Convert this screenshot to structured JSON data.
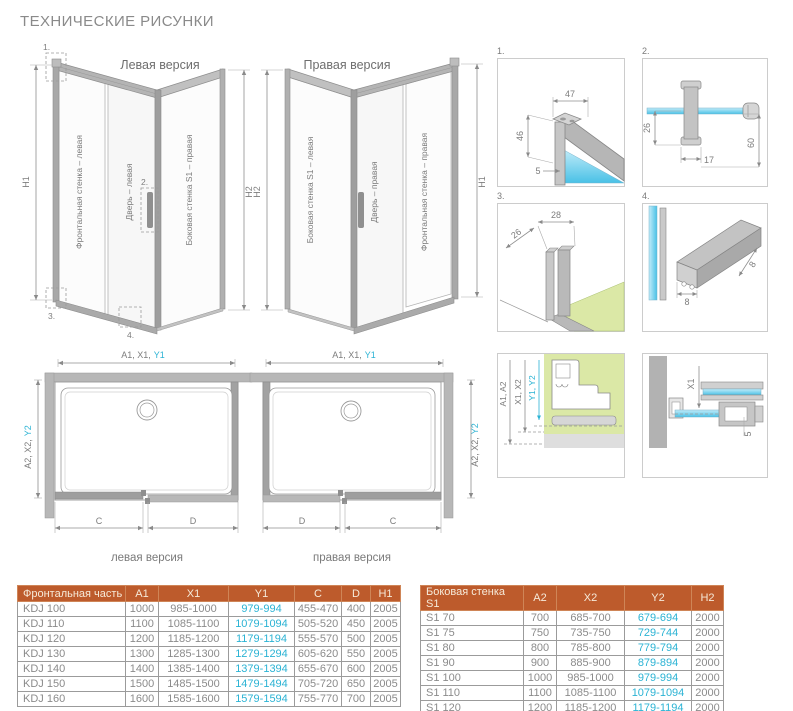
{
  "title": "ТЕХНИЧЕСКИЕ РИСУНКИ",
  "colors": {
    "accent_orange": "#bd5b2c",
    "cyan": "#2bb3d4",
    "wall_green": "#dbe8a6",
    "glass_blue": "#49c1e6",
    "line_gray": "#8f8f8f"
  },
  "iso_left": {
    "caption": "Левая версия",
    "panel_front": "Фронтальная стенка – левая",
    "panel_door": "Дверь – левая",
    "panel_side": "Боковая стенка S1 – правая",
    "dim_left": "H1",
    "dim_right": "H2"
  },
  "iso_right": {
    "caption": "Правая версия",
    "panel_side": "Боковая стенка S1 – левая",
    "panel_door": "Дверь – правая",
    "panel_front": "Фронтальная стенка – правая",
    "dim_left": "H2",
    "dim_right": "H1"
  },
  "details": {
    "d1": {
      "label": "1.",
      "a": "47",
      "b": "46",
      "c": "5"
    },
    "d2": {
      "label": "2.",
      "a": "26",
      "b": "17",
      "c": "60"
    },
    "d3": {
      "label": "3.",
      "a": "28",
      "b": "26"
    },
    "d4": {
      "label": "4.",
      "a": "8",
      "b": "8"
    },
    "d5": {
      "a": "A1, A2",
      "b": "X1, X2",
      "c": "Y1, Y2"
    },
    "d6": {
      "a": "X1",
      "b": "5"
    }
  },
  "plan_left": {
    "caption": "левая версия",
    "top_dim": "A1, X1,",
    "top_dim_cyan": "Y1",
    "side_dim": "A2, X2,",
    "side_dim_cyan": "Y2",
    "dim_c": "C",
    "dim_d": "D"
  },
  "plan_right": {
    "caption": "правая версия",
    "top_dim": "A1, X1,",
    "top_dim_cyan": "Y1",
    "side_dim": "A2, X2,",
    "side_dim_cyan": "Y2",
    "dim_c": "C",
    "dim_d": "D"
  },
  "tables": {
    "front": {
      "headers": [
        "Фронтальная часть",
        "A1",
        "X1",
        "Y1",
        "C",
        "D",
        "H1"
      ],
      "cyan_col": 3,
      "rows": [
        [
          "KDJ 100",
          "1000",
          "985-1000",
          "979-994",
          "455-470",
          "400",
          "2005"
        ],
        [
          "KDJ 110",
          "1100",
          "1085-1100",
          "1079-1094",
          "505-520",
          "450",
          "2005"
        ],
        [
          "KDJ 120",
          "1200",
          "1185-1200",
          "1179-1194",
          "555-570",
          "500",
          "2005"
        ],
        [
          "KDJ 130",
          "1300",
          "1285-1300",
          "1279-1294",
          "605-620",
          "550",
          "2005"
        ],
        [
          "KDJ 140",
          "1400",
          "1385-1400",
          "1379-1394",
          "655-670",
          "600",
          "2005"
        ],
        [
          "KDJ 150",
          "1500",
          "1485-1500",
          "1479-1494",
          "705-720",
          "650",
          "2005"
        ],
        [
          "KDJ 160",
          "1600",
          "1585-1600",
          "1579-1594",
          "755-770",
          "700",
          "2005"
        ]
      ]
    },
    "side": {
      "headers": [
        "Боковая стенка S1",
        "A2",
        "X2",
        "Y2",
        "H2"
      ],
      "cyan_col": 3,
      "rows": [
        [
          "S1 70",
          "700",
          "685-700",
          "679-694",
          "2000"
        ],
        [
          "S1 75",
          "750",
          "735-750",
          "729-744",
          "2000"
        ],
        [
          "S1 80",
          "800",
          "785-800",
          "779-794",
          "2000"
        ],
        [
          "S1 90",
          "900",
          "885-900",
          "879-894",
          "2000"
        ],
        [
          "S1 100",
          "1000",
          "985-1000",
          "979-994",
          "2000"
        ],
        [
          "S1 110",
          "1100",
          "1085-1100",
          "1079-1094",
          "2000"
        ],
        [
          "S1 120",
          "1200",
          "1185-1200",
          "1179-1194",
          "2000"
        ]
      ]
    }
  }
}
